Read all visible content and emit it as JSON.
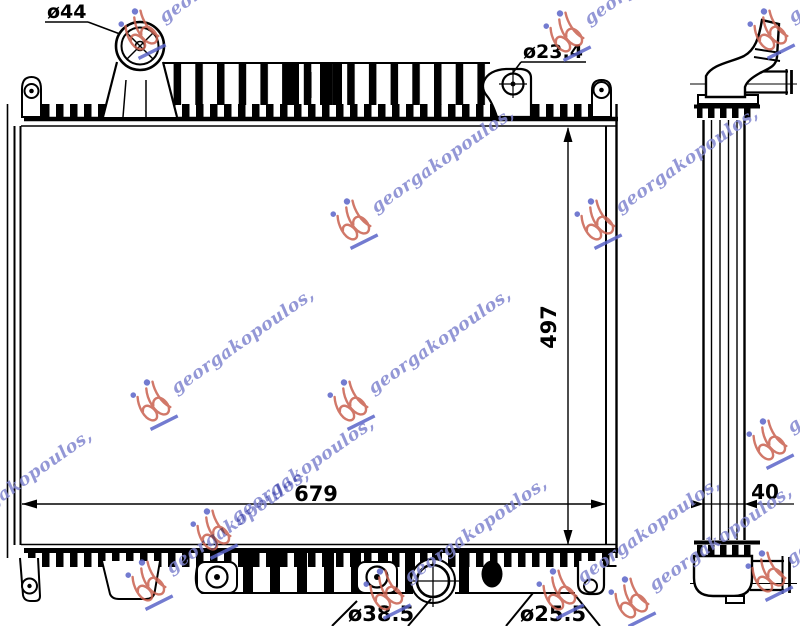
{
  "labels": {
    "filler_neck_diameter": "ø44",
    "bracket_hole_diameter": "ø23.4",
    "core_height_mm": "497",
    "core_width_mm": "679",
    "core_depth_mm": "40",
    "drain_hole_diameter": "ø38.5",
    "outlet_hole_diameter": "ø25.5"
  },
  "watermark": {
    "text": "georgakopoulos,",
    "text_color": "#8085cf",
    "logo_red": "#c9604f",
    "logo_blue": "#5a64c8"
  },
  "colors": {
    "line": "#000000",
    "background": "#ffffff"
  }
}
